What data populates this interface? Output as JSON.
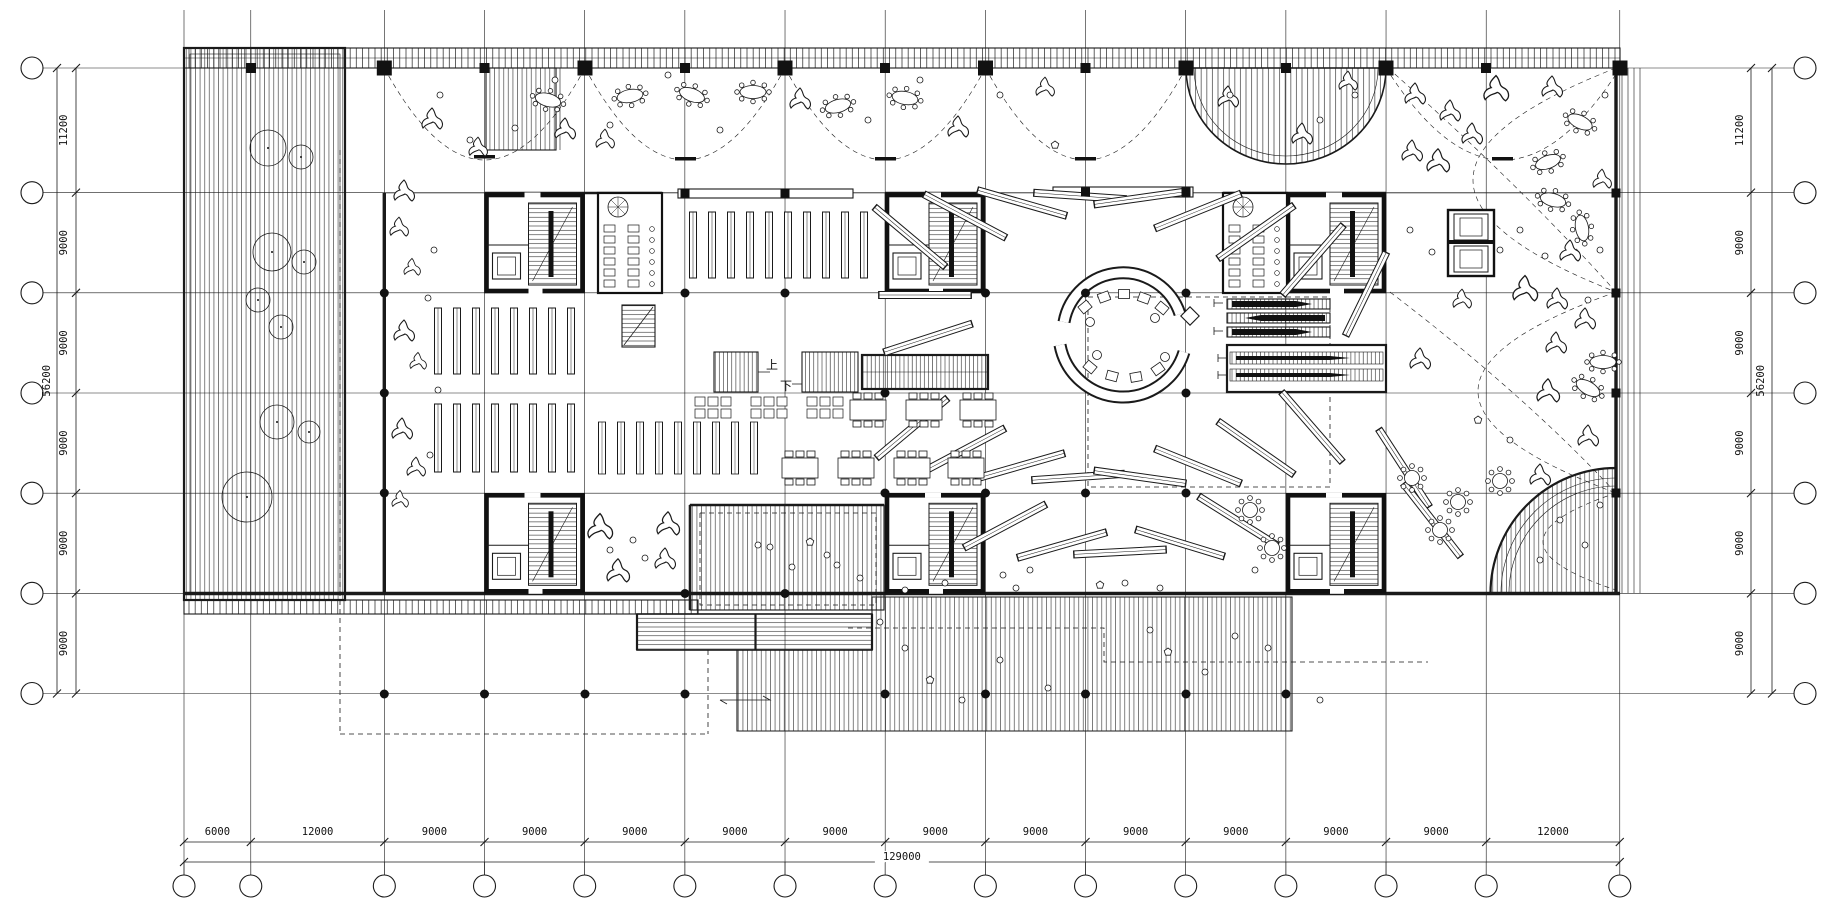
{
  "plan": {
    "type": "architectural-floor-plan",
    "labels": {
      "up": "上",
      "down": "下"
    },
    "dimensions": {
      "bottom": {
        "segments": [
          "6000",
          "12000",
          "9000",
          "9000",
          "9000",
          "9000",
          "9000",
          "9000",
          "9000",
          "9000",
          "9000",
          "9000",
          "9000",
          "12000"
        ],
        "total": "129000"
      },
      "left": {
        "segments": [
          "11200",
          "9000",
          "9000",
          "9000",
          "9000",
          "9000"
        ],
        "total": "56200"
      },
      "right": {
        "segments": [
          "11200",
          "9000",
          "9000",
          "9000",
          "9000",
          "9000"
        ],
        "total": "56200"
      }
    },
    "colors": {
      "line": "#1a1a1a",
      "background": "#ffffff"
    }
  }
}
